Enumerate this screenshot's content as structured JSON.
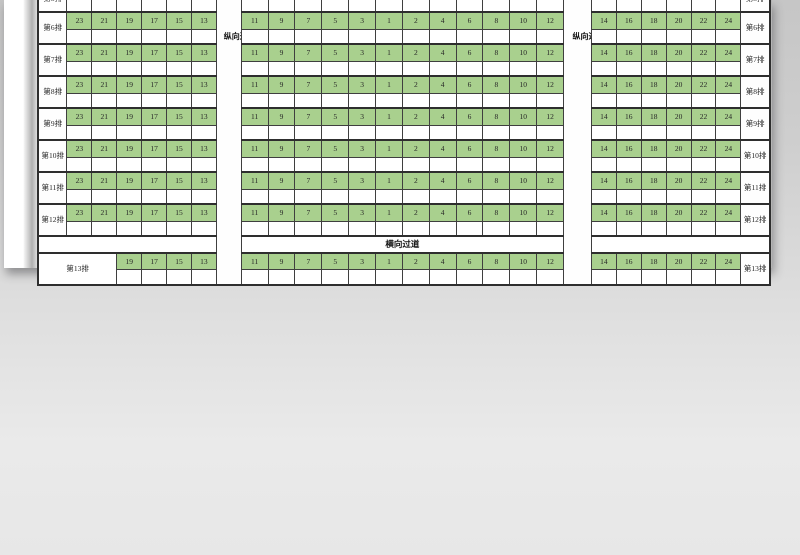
{
  "sheet": {
    "partial_top_row_label": "第5排",
    "row_labels": [
      "第6排",
      "第7排",
      "第8排",
      "第9排",
      "第10排",
      "第11排",
      "第12排"
    ],
    "left_seats": [
      "23",
      "21",
      "19",
      "17",
      "15",
      "13"
    ],
    "middle_seats": [
      "11",
      "9",
      "7",
      "5",
      "3",
      "1",
      "2",
      "4",
      "6",
      "8",
      "10",
      "12"
    ],
    "right_seats": [
      "14",
      "16",
      "18",
      "20",
      "22",
      "24"
    ],
    "row13": {
      "label": "第13排",
      "left_seats": [
        "19",
        "17",
        "15",
        "13"
      ],
      "middle_seats": [
        "11",
        "9",
        "7",
        "5",
        "3",
        "1",
        "2",
        "4",
        "6",
        "8",
        "10",
        "12"
      ]
    },
    "vertical_aisle_label": "纵向过道",
    "horizontal_aisle_label": "横向过道",
    "colors": {
      "seat_green": "#a9d08e",
      "border": "#3f3f3f"
    }
  },
  "photo": {
    "objects": [
      "hand",
      "fountain-pen"
    ]
  }
}
